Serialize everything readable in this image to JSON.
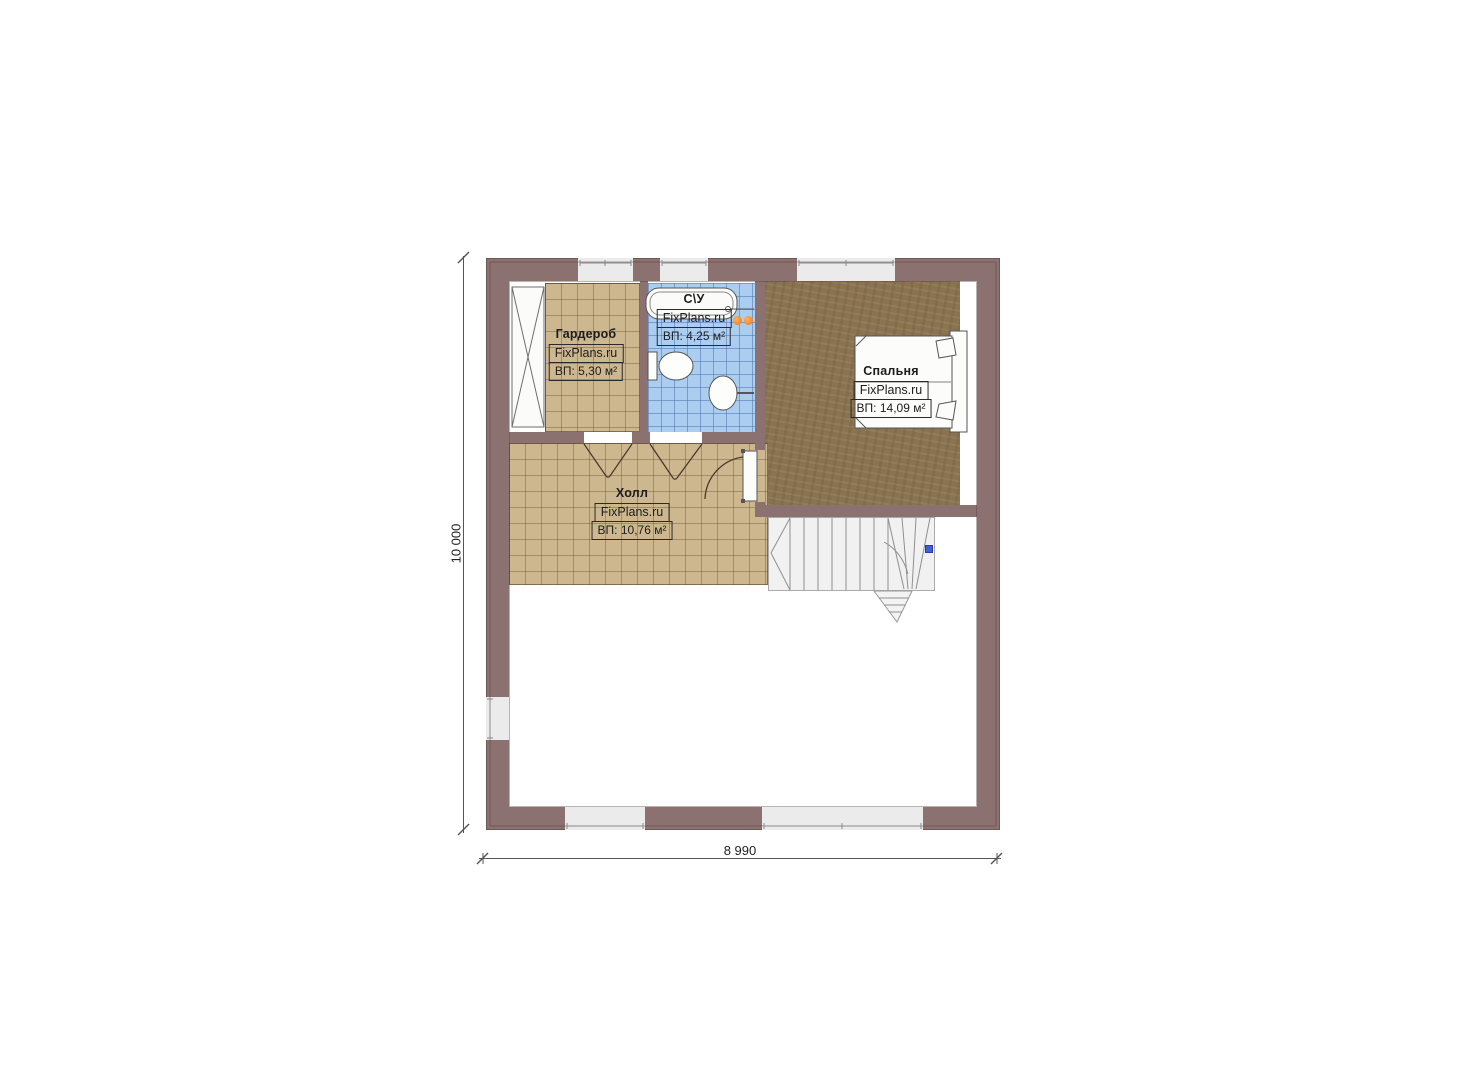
{
  "rooms": {
    "wardrobe": {
      "name": "Гардероб",
      "brand": "FixPlans.ru",
      "area": "ВП: 5,30 м²"
    },
    "bathroom": {
      "name": "С\\У",
      "brand": "FixPlans.ru",
      "area": "ВП: 4,25 м²"
    },
    "bedroom": {
      "name": "Спальня",
      "brand": "FixPlans.ru",
      "area": "ВП: 14,09 м²"
    },
    "hall": {
      "name": "Холл",
      "brand": "FixPlans.ru",
      "area": "ВП: 10,76 м²"
    }
  },
  "dimensions": {
    "overall_height": "10 000",
    "overall_width": "8 990"
  },
  "colors": {
    "wall": "#8b7270",
    "floor_tile": "#cdb78f",
    "bathroom_tile": "#abcdf0",
    "wood_floor": "#8b7351",
    "stairs": "#f1f1f1",
    "radiator_orange": "#f58220",
    "marker_blue": "#3f5ed8"
  }
}
